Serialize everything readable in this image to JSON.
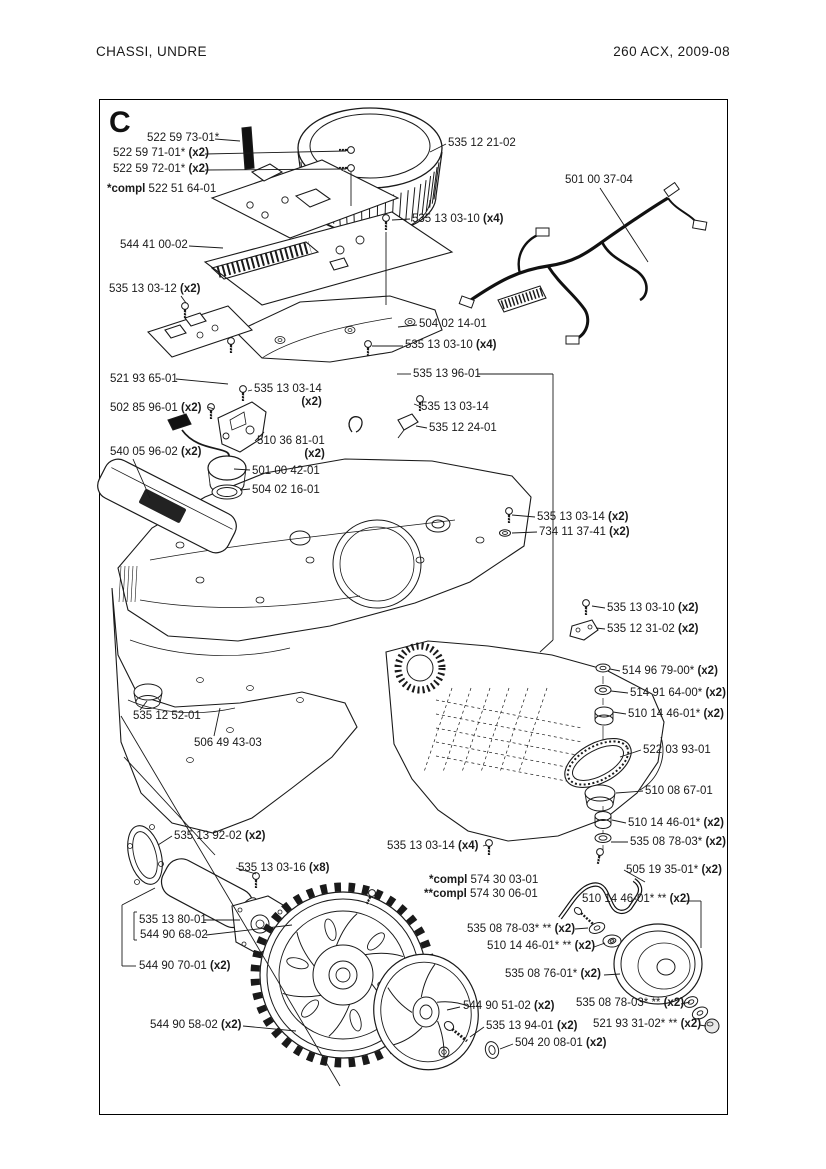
{
  "page": {
    "header_left": "CHASSI, UNDRE",
    "header_right": "260 ACX, 2009-08",
    "section_letter": "C"
  },
  "diagram": {
    "labels": [
      {
        "t": "522 59 73-01*",
        "q": "",
        "x": 147,
        "y": 132
      },
      {
        "t": "522 59 71-01*",
        "q": "(x2)",
        "x": 113,
        "y": 147
      },
      {
        "t": "522 59 72-01*",
        "q": "(x2)",
        "x": 113,
        "y": 163
      },
      {
        "p": "*compl",
        "t": "522 51 64-01",
        "q": "",
        "x": 107,
        "y": 183
      },
      {
        "t": "544 41 00-02",
        "q": "",
        "x": 120,
        "y": 239
      },
      {
        "t": "535 13 03-12",
        "q": "(x2)",
        "x": 109,
        "y": 283
      },
      {
        "t": "535 12 21-02",
        "q": "",
        "x": 448,
        "y": 137
      },
      {
        "t": "501 00 37-04",
        "q": "",
        "x": 565,
        "y": 174
      },
      {
        "t": "535 13 03-10",
        "q": "(x4)",
        "x": 412,
        "y": 213
      },
      {
        "t": "504 02 14-01",
        "q": "",
        "x": 419,
        "y": 318
      },
      {
        "t": "535 13 03-10",
        "q": "(x4)",
        "x": 405,
        "y": 339
      },
      {
        "t": "535 13 96-01",
        "q": "",
        "x": 413,
        "y": 368
      },
      {
        "t": "521 93 65-01",
        "q": "",
        "x": 110,
        "y": 373
      },
      {
        "t": "535 13 03-14",
        "q": "(x2)",
        "tl": true,
        "x": 254,
        "y": 383
      },
      {
        "t": "502 85 96-01",
        "q": "(x2)",
        "x": 110,
        "y": 402
      },
      {
        "t": "535 13 03-14",
        "q": "",
        "x": 421,
        "y": 401
      },
      {
        "t": "535 12 24-01",
        "q": "",
        "x": 429,
        "y": 422
      },
      {
        "t": "510 36 81-01",
        "q": "(x2)",
        "tl": true,
        "x": 257,
        "y": 435
      },
      {
        "t": "540 05 96-02",
        "q": "(x2)",
        "x": 110,
        "y": 446
      },
      {
        "t": "501 00 42-01",
        "q": "",
        "x": 252,
        "y": 465
      },
      {
        "t": "504 02 16-01",
        "q": "",
        "x": 252,
        "y": 484
      },
      {
        "t": "535 13 03-14",
        "q": "(x2)",
        "x": 537,
        "y": 511
      },
      {
        "t": "734 11 37-41",
        "q": "(x2)",
        "x": 539,
        "y": 526
      },
      {
        "t": "535 13 03-10",
        "q": "(x2)",
        "x": 607,
        "y": 602
      },
      {
        "t": "535 12 31-02",
        "q": "(x2)",
        "x": 607,
        "y": 623
      },
      {
        "t": "514 96 79-00*",
        "q": "(x2)",
        "x": 622,
        "y": 665
      },
      {
        "t": "514 91 64-00*",
        "q": "(x2)",
        "x": 630,
        "y": 687
      },
      {
        "t": "510 14 46-01*",
        "q": "(x2)",
        "x": 628,
        "y": 708
      },
      {
        "t": "522 03 93-01",
        "q": "",
        "x": 643,
        "y": 744
      },
      {
        "t": "510 08 67-01",
        "q": "",
        "x": 645,
        "y": 785
      },
      {
        "t": "510 14 46-01*",
        "q": "(x2)",
        "x": 628,
        "y": 817
      },
      {
        "t": "535 08 78-03*",
        "q": "(x2)",
        "x": 630,
        "y": 836
      },
      {
        "t": "505 19 35-01*",
        "q": "(x2)",
        "x": 626,
        "y": 864
      },
      {
        "t": "535 12 52-01",
        "q": "",
        "x": 133,
        "y": 710
      },
      {
        "t": "506 49 43-03",
        "q": "",
        "x": 194,
        "y": 737
      },
      {
        "t": "535 13 92-02",
        "q": "(x2)",
        "x": 174,
        "y": 830
      },
      {
        "t": "535 13 03-16",
        "q": "(x8)",
        "x": 238,
        "y": 862
      },
      {
        "t": "535 13 80-01",
        "q": "",
        "x": 139,
        "y": 914
      },
      {
        "t": "544 90 68-02",
        "q": "",
        "x": 140,
        "y": 929
      },
      {
        "t": "544 90 70-01",
        "q": "(x2)",
        "x": 139,
        "y": 960
      },
      {
        "t": "535 13 03-14",
        "q": "(x4)",
        "x": 387,
        "y": 840
      },
      {
        "p": "*compl",
        "t": "574 30 03-01",
        "q": "",
        "x": 429,
        "y": 874
      },
      {
        "p": "**compl",
        "t": "574 30 06-01",
        "q": "",
        "x": 424,
        "y": 888
      },
      {
        "t": "510 14 46-01* **",
        "q": "(x2)",
        "x": 582,
        "y": 893
      },
      {
        "t": "535 08 78-03* **",
        "q": "(x2)",
        "x": 467,
        "y": 923
      },
      {
        "t": "510 14 46-01* **",
        "q": "(x2)",
        "x": 487,
        "y": 940
      },
      {
        "t": "535 08 76-01*",
        "q": "(x2)",
        "x": 505,
        "y": 968
      },
      {
        "t": "544 90 51-02",
        "q": "(x2)",
        "x": 463,
        "y": 1000
      },
      {
        "t": "535 08 78-03* **",
        "q": "(x2)",
        "x": 576,
        "y": 997
      },
      {
        "t": "535 13 94-01",
        "q": "(x2)",
        "x": 486,
        "y": 1020
      },
      {
        "t": "521 93 31-02* **",
        "q": "(x2)",
        "x": 593,
        "y": 1018
      },
      {
        "t": "504 20 08-01",
        "q": "(x2)",
        "x": 515,
        "y": 1037
      },
      {
        "t": "544 90 58-02",
        "q": "(x2)",
        "x": 150,
        "y": 1019
      }
    ]
  }
}
